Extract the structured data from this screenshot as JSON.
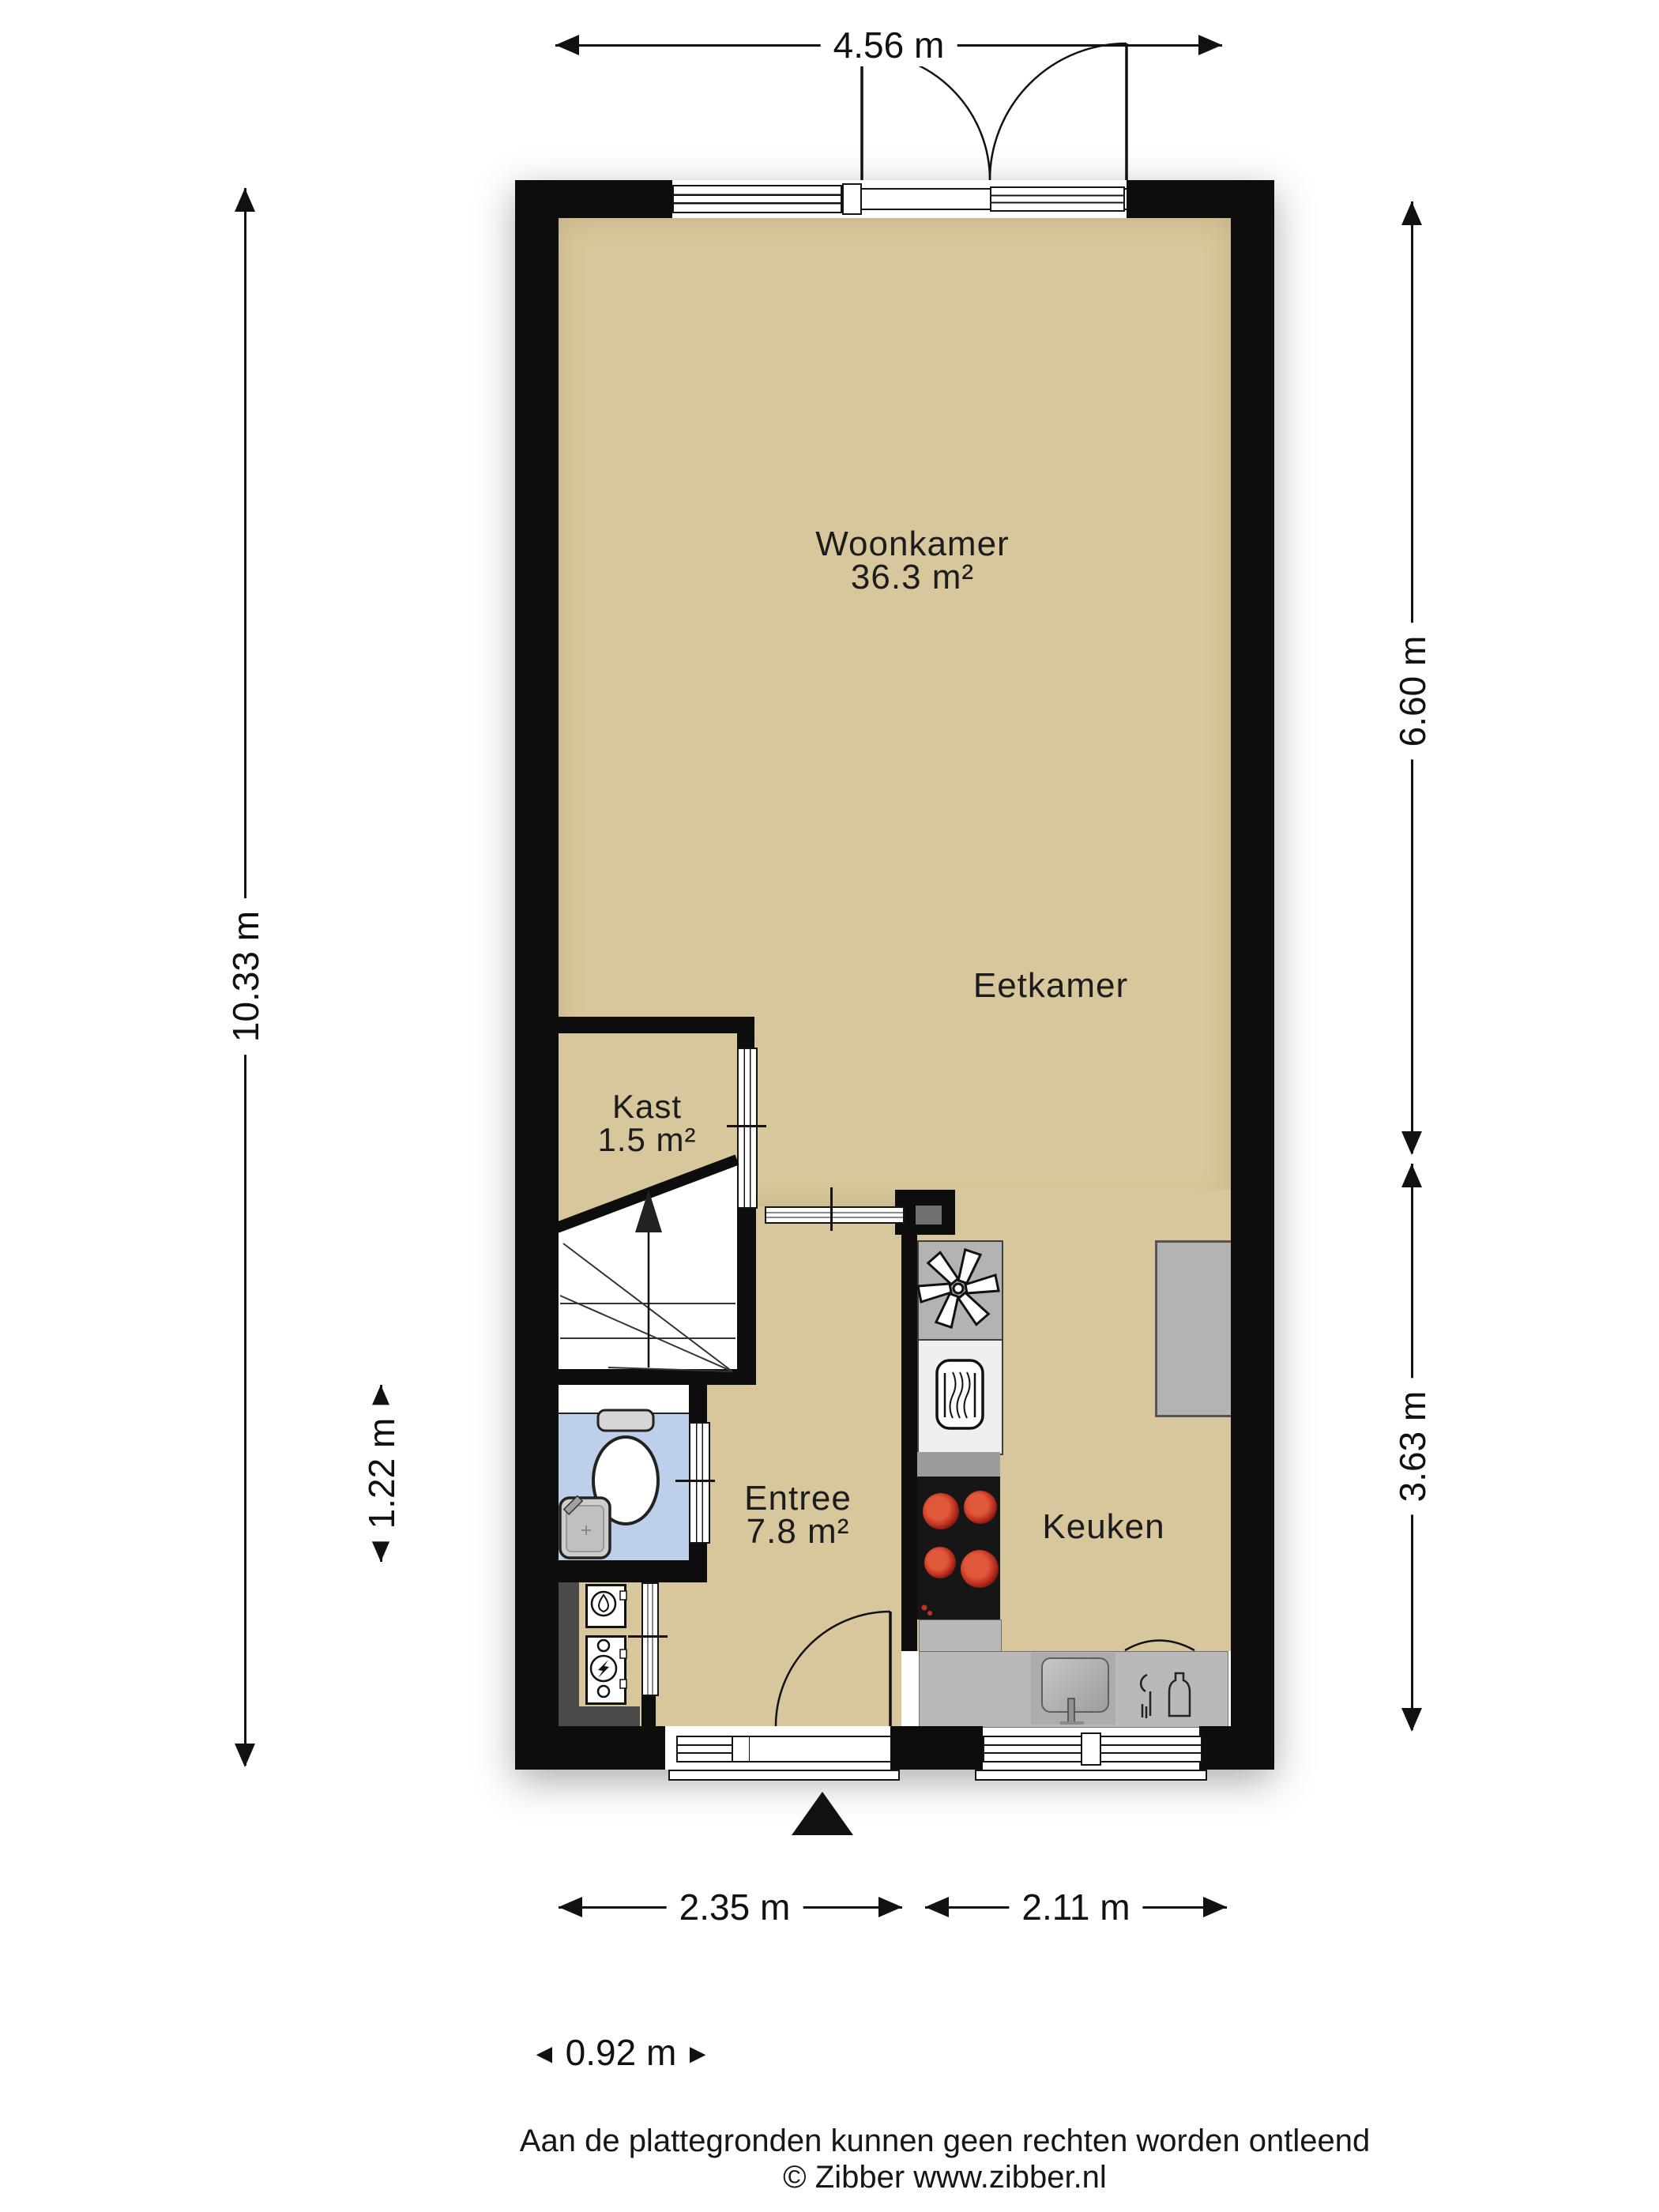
{
  "plan": {
    "title": "Floor plan (plattegrond) - begane grond",
    "rooms": [
      {
        "name": "Woonkamer",
        "area": "36.3 m²"
      },
      {
        "name": "Eetkamer",
        "area": ""
      },
      {
        "name": "Kast",
        "area": "1.5 m²"
      },
      {
        "name": "Entree",
        "area": "7.8 m²"
      },
      {
        "name": "Keuken",
        "area": ""
      }
    ],
    "dimensions": {
      "top": "4.56 m",
      "left_total": "10.33 m",
      "left_toilet": "1.22 m",
      "right_upper": "6.60 m",
      "right_lower": "3.63 m",
      "bottom_left": "2.35 m",
      "bottom_right": "2.11 m",
      "bottom_small": {
        "left_arrow": "◄",
        "value": "0.92 m",
        "right_arrow": "►"
      }
    },
    "footer": {
      "disclaimer": "Aan de plattegronden kunnen geen rechten worden ontleend",
      "copyright": "© Zibber www.zibber.nl"
    },
    "colors": {
      "floor": "#d8c79c",
      "walls": "#0d0d0d",
      "toilet_floor": "#bdcfe9",
      "counter": "#b9b9b9",
      "appliance_gray": "#b3b3b3",
      "oven_white": "#efefef",
      "cooktop": "#161616",
      "burner_red": "#c23322",
      "cabinet": "#b3b3b3",
      "meter_closet_dark": "#4a4a4a",
      "glass_frame": "#141414",
      "text": "#1b1b1b"
    },
    "icons": {
      "extractor": "fan-icon",
      "oven": "oven-icon",
      "cooktop": "cooktop-burners-icon",
      "kitchen_sink": "sink-icon",
      "dishwasher": "dishwasher-icon",
      "toilet": "toilet-icon",
      "washbasin": "washbasin-icon",
      "water_heater": "water-heater-icon",
      "electric_meter": "electric-meter-icon",
      "stairs": "stairs-up-icon",
      "entrance": "entrance-arrow-icon",
      "door_swing": "door-arc-icon"
    }
  }
}
